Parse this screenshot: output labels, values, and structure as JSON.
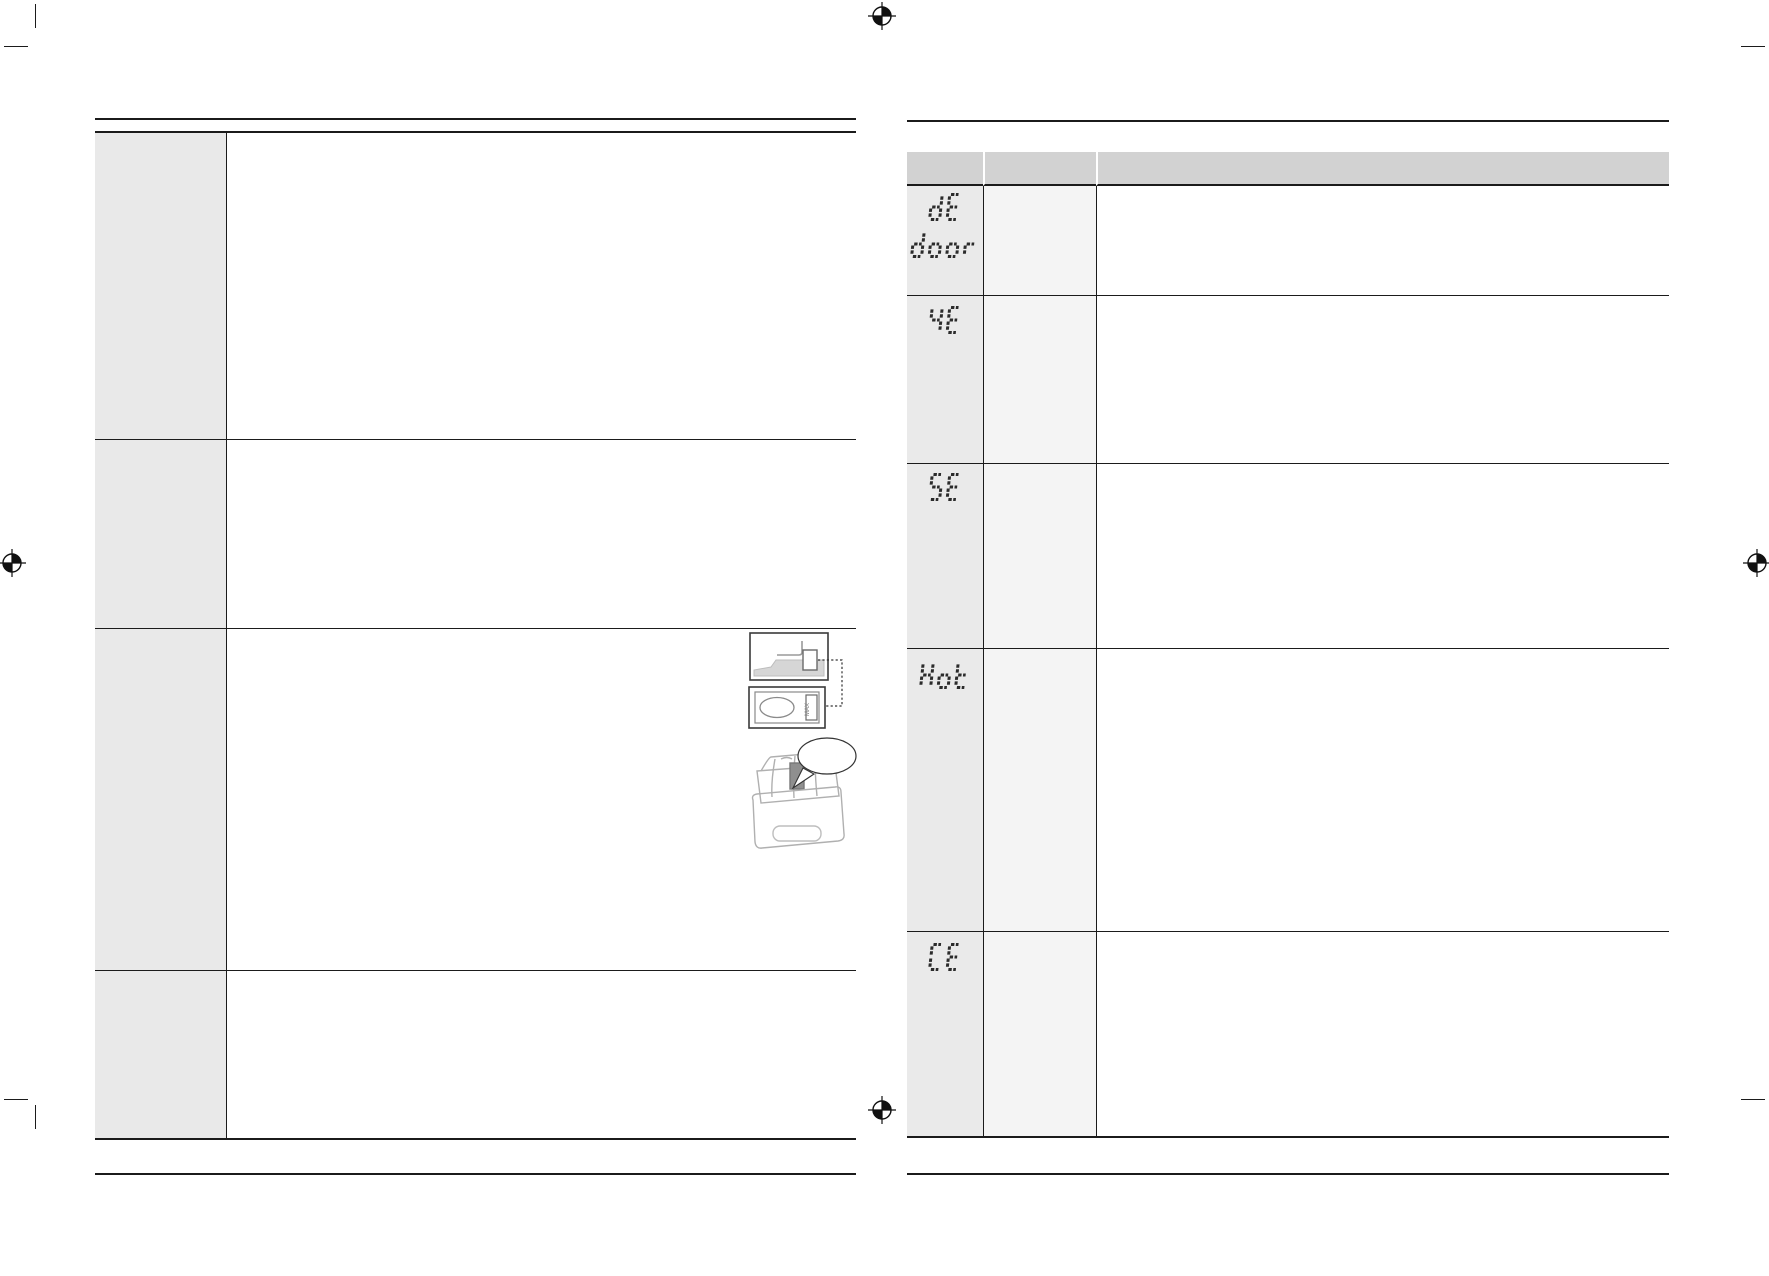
{
  "document": {
    "kind_label": "appliance manual troubleshooting spread (text stripped)",
    "colors": {
      "page_bg": "#ffffff",
      "border": "#1b1b1b",
      "left_label_cell_bg": "#e9e9e9",
      "right_header_bg": "#d2d2d2",
      "right_code_cell_bg": "#eaeaea",
      "right_secondary_cell_bg": "#f4f4f4",
      "segment_color": "#2b2b2b",
      "illustration_stroke": "#9a9a9a"
    }
  },
  "left_page": {
    "rows": [
      {
        "label": "",
        "content": ""
      },
      {
        "label": "",
        "content": ""
      },
      {
        "label": "",
        "content": ""
      },
      {
        "label": "",
        "content": ""
      }
    ],
    "illustration": {
      "max_label": "MAX",
      "bubble_text": ""
    }
  },
  "right_page": {
    "header": {
      "symbol_col": "",
      "meaning_col": "",
      "solution_col": ""
    },
    "rows": [
      {
        "code": "dE",
        "code2": "door",
        "meaning": "",
        "solution": ""
      },
      {
        "code": "4E",
        "code2": "",
        "meaning": "",
        "solution": ""
      },
      {
        "code": "5E",
        "code2": "",
        "meaning": "",
        "solution": ""
      },
      {
        "code": "Hot",
        "code2": "",
        "meaning": "",
        "solution": ""
      },
      {
        "code": "CE",
        "code2": "",
        "meaning": "",
        "solution": ""
      }
    ]
  }
}
